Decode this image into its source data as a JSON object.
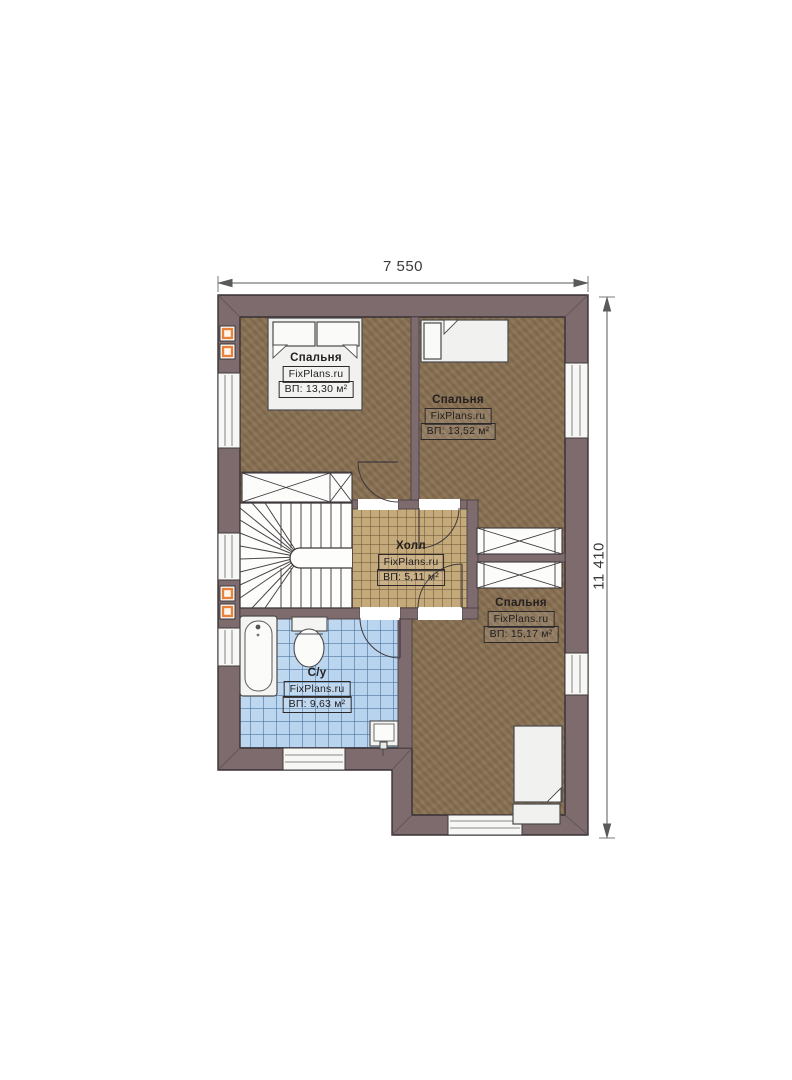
{
  "plan": {
    "dimension_top": "7 550",
    "dimension_right": "11 410"
  },
  "rooms": {
    "bedroom1": {
      "label": "Спальня",
      "watermark": "FixPlans.ru",
      "area": "ВП: 13,30 м²"
    },
    "bedroom2": {
      "label": "Спальня",
      "watermark": "FixPlans.ru",
      "area": "ВП: 13,52 м²"
    },
    "hall": {
      "label": "Холл",
      "watermark": "FixPlans.ru",
      "area": "ВП: 5,11 м²"
    },
    "bedroom3": {
      "label": "Спальня",
      "watermark": "FixPlans.ru",
      "area": "ВП: 15,17 м²"
    },
    "bathroom": {
      "label": "С/у",
      "watermark": "FixPlans.ru",
      "area": "ВП: 9,63 м²"
    }
  },
  "colors": {
    "wall": "#7d6b6d",
    "bedroom_floor": "#8a7254",
    "hall_floor": "#c4a97b",
    "bathroom_floor": "#b7d3ee",
    "vent_accent": "#e8823b",
    "furniture": "#f1f1ef"
  }
}
